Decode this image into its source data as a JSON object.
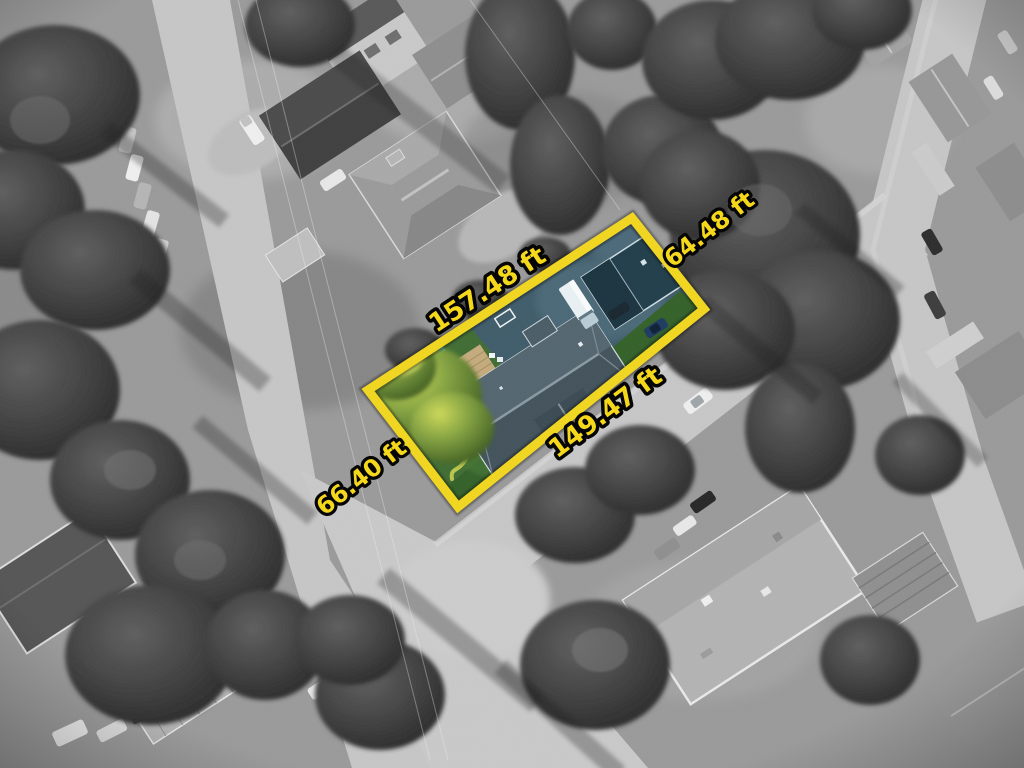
{
  "scene": {
    "name": "aerial-lot-photo",
    "surroundings_style": "grayscale",
    "subject_lot_style": "color-highlighted"
  },
  "lot": {
    "boundary_color": "#F2D71E",
    "label_text_color": "#F7D916",
    "label_outline_color": "#000000",
    "dimensions": [
      {
        "side": "northwest",
        "text": "157.48 ft"
      },
      {
        "side": "northeast",
        "text": "64.48 ft"
      },
      {
        "side": "southeast",
        "text": "149.47 ft"
      },
      {
        "side": "southwest",
        "text": "66.40 ft"
      }
    ]
  }
}
